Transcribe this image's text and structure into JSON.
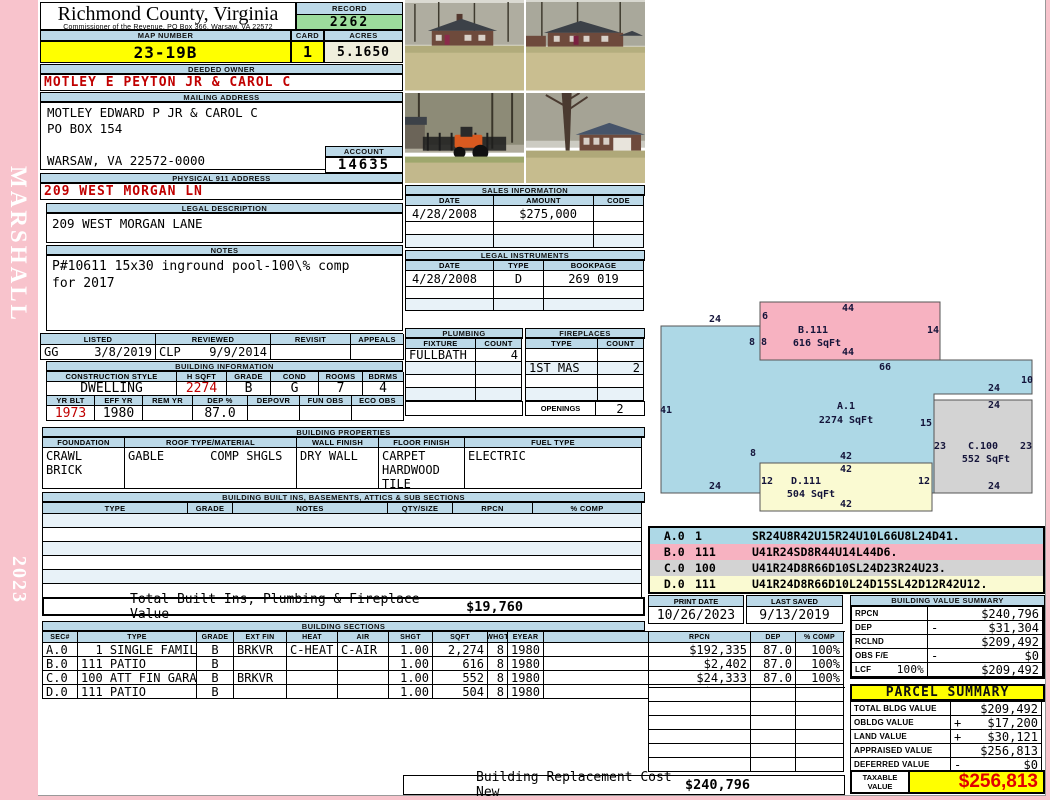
{
  "sidebar": {
    "vendor": "MARSHALL",
    "year": "2023"
  },
  "header": {
    "title": "Richmond County, Virginia",
    "subtitle": "Commissioner of the Revenue, PO Box 366, Warsaw, VA 22572",
    "record_label": "RECORD",
    "record": "2262",
    "map_label": "MAP NUMBER",
    "map": "23-19B",
    "card_label": "CARD",
    "card": "1",
    "acres_label": "ACRES",
    "acres": "5.1650"
  },
  "owner": {
    "section": "DEEDED OWNER",
    "name": "MOTLEY E PEYTON JR & CAROL C"
  },
  "mailing": {
    "section": "MAILING ADDRESS",
    "address": "MOTLEY EDWARD P JR & CAROL C\nPO BOX 154\n\nWARSAW, VA 22572-0000",
    "account_label": "ACCOUNT",
    "account": "14635"
  },
  "physical": {
    "section": "PHYSICAL 911 ADDRESS",
    "address": "209 WEST MORGAN LN"
  },
  "legal": {
    "section": "LEGAL DESCRIPTION",
    "text": "209 WEST MORGAN LANE"
  },
  "notes": {
    "section": "NOTES",
    "text": "P#10611 15x30 inground pool-100\\% comp\nfor 2017"
  },
  "review": {
    "headers": [
      "LISTED",
      "REVIEWED",
      "REVISIT",
      "APPEALS"
    ],
    "listed_by": "GG",
    "listed_date": "3/8/2019",
    "reviewed_by": "CLP",
    "reviewed_date": "9/9/2014",
    "revisit": "",
    "appeals": ""
  },
  "building_info": {
    "section": "BUILDING INFORMATION",
    "row1_headers": [
      "CONSTRUCTION STYLE",
      "H SQFT",
      "GRADE",
      "COND",
      "ROOMS",
      "BDRMS"
    ],
    "style": "DWELLING",
    "hsqft": "2274",
    "grade": "B",
    "cond": "G",
    "rooms": "7",
    "bdrms": "4",
    "row2_headers": [
      "YR BLT",
      "EFF YR",
      "REM YR",
      "DEP %",
      "DEPOVR",
      "FUN OBS",
      "ECO OBS"
    ],
    "yr_blt": "1973",
    "eff_yr": "1980",
    "rem_yr": "",
    "dep_pct": "87.0",
    "depovr": "",
    "fun_obs": "",
    "eco_obs": ""
  },
  "properties": {
    "section": "BUILDING PROPERTIES",
    "headers": [
      "FOUNDATION",
      "ROOF TYPE/MATERIAL",
      "WALL FINISH",
      "FLOOR FINISH",
      "FUEL TYPE"
    ],
    "foundation": "CRAWL\nBRICK",
    "roof_type": "GABLE",
    "roof_material": "COMP SHGLS",
    "wall_finish": "DRY WALL",
    "floor_finish": "CARPET\nHARDWOOD\nTILE",
    "fuel_type": "ELECTRIC"
  },
  "built_ins": {
    "section": "BUILDING BUILT INS, BASEMENTS, ATTICS & SUB SECTIONS",
    "headers": [
      "TYPE",
      "GRADE",
      "NOTES",
      "QTY/SIZE",
      "RPCN",
      "% COMP"
    ],
    "total_label": "Total Built Ins, Plumbing & Fireplace Value",
    "total_value": "$19,760"
  },
  "sales": {
    "section": "SALES INFORMATION",
    "headers": [
      "DATE",
      "AMOUNT",
      "CODE"
    ],
    "rows": [
      [
        "4/28/2008",
        "$275,000",
        ""
      ],
      [
        "",
        "",
        ""
      ],
      [
        "",
        "",
        ""
      ]
    ]
  },
  "instruments": {
    "section": "LEGAL INSTRUMENTS",
    "headers": [
      "DATE",
      "TYPE",
      "BOOKPAGE"
    ],
    "rows": [
      [
        "4/28/2008",
        "D",
        "269 019"
      ],
      [
        "",
        "",
        ""
      ],
      [
        "",
        "",
        ""
      ]
    ]
  },
  "plumbing": {
    "section": "PLUMBING",
    "headers": [
      "FIXTURE",
      "COUNT"
    ],
    "rows": [
      [
        "FULLBATH",
        "4"
      ],
      [
        "",
        ""
      ],
      [
        "",
        ""
      ],
      [
        "",
        ""
      ]
    ]
  },
  "fireplaces": {
    "section": "FIREPLACES",
    "headers": [
      "TYPE",
      "COUNT"
    ],
    "rows": [
      [
        "",
        ""
      ],
      [
        "1ST MAS",
        "2"
      ],
      [
        "",
        ""
      ],
      [
        "",
        ""
      ]
    ],
    "openings_label": "OPENINGS",
    "openings": "2"
  },
  "sketch": {
    "colors": {
      "blue": "#ADD8E6",
      "pink": "#F7B2C1",
      "gray": "#D3D3D3",
      "yellow": "#FAFAD2"
    },
    "shapes": [
      {
        "name": "A",
        "fill": "blue",
        "type": "polygon",
        "points": [
          [
            11,
            36
          ],
          [
            110,
            36
          ],
          [
            110,
            70
          ],
          [
            382,
            70
          ],
          [
            382,
            104
          ],
          [
            284,
            104
          ],
          [
            284,
            203
          ],
          [
            11,
            203
          ]
        ]
      },
      {
        "name": "B",
        "fill": "pink",
        "type": "rect",
        "x": 110,
        "y": 12,
        "w": 180,
        "h": 58
      },
      {
        "name": "C",
        "fill": "gray",
        "type": "rect",
        "x": 284,
        "y": 110,
        "w": 98,
        "h": 93
      },
      {
        "name": "D",
        "fill": "yellow",
        "type": "rect",
        "x": 110,
        "y": 173,
        "w": 172,
        "h": 48
      }
    ],
    "labels": [
      {
        "t": "24",
        "x": 65,
        "y": 32
      },
      {
        "t": "41",
        "x": 16,
        "y": 123
      },
      {
        "t": "24",
        "x": 65,
        "y": 199
      },
      {
        "t": "66",
        "x": 235,
        "y": 80
      },
      {
        "t": "10",
        "x": 377,
        "y": 93
      },
      {
        "t": "24",
        "x": 344,
        "y": 101
      },
      {
        "t": "15",
        "x": 276,
        "y": 136
      },
      {
        "t": "42",
        "x": 196,
        "y": 169
      },
      {
        "t": "8",
        "x": 103,
        "y": 166
      },
      {
        "t": "A.1",
        "x": 196,
        "y": 119
      },
      {
        "t": "2274 SqFt",
        "x": 196,
        "y": 133
      },
      {
        "t": "44",
        "x": 198,
        "y": 21
      },
      {
        "t": "6",
        "x": 115,
        "y": 29
      },
      {
        "t": "8",
        "x": 102,
        "y": 55
      },
      {
        "t": "8",
        "x": 114,
        "y": 55
      },
      {
        "t": "B.111",
        "x": 163,
        "y": 43
      },
      {
        "t": "616 SqFt",
        "x": 167,
        "y": 56
      },
      {
        "t": "14",
        "x": 283,
        "y": 43
      },
      {
        "t": "44",
        "x": 198,
        "y": 65
      },
      {
        "t": "24",
        "x": 344,
        "y": 118
      },
      {
        "t": "23",
        "x": 290,
        "y": 159
      },
      {
        "t": "C.100",
        "x": 333,
        "y": 159
      },
      {
        "t": "23",
        "x": 376,
        "y": 159
      },
      {
        "t": "552 SqFt",
        "x": 336,
        "y": 172
      },
      {
        "t": "24",
        "x": 344,
        "y": 199
      },
      {
        "t": "42",
        "x": 196,
        "y": 182
      },
      {
        "t": "12",
        "x": 117,
        "y": 194
      },
      {
        "t": "D.111",
        "x": 156,
        "y": 194
      },
      {
        "t": "12",
        "x": 274,
        "y": 194
      },
      {
        "t": "504 SqFt",
        "x": 161,
        "y": 207
      },
      {
        "t": "42",
        "x": 196,
        "y": 217
      }
    ]
  },
  "sketch_codes": {
    "rows": [
      {
        "sec": "A.0",
        "code": "1",
        "vector": "SR24U8R42U15R24U10L66U8L24D41.",
        "color": "blue"
      },
      {
        "sec": "B.0",
        "code": "111",
        "vector": "U41R24SD8R44U14L44D6.",
        "color": "pink"
      },
      {
        "sec": "C.0",
        "code": "100",
        "vector": "U41R24D8R66D10SL24D23R24U23.",
        "color": "gray"
      },
      {
        "sec": "D.0",
        "code": "111",
        "vector": "U41R24D8R66D10L24D15SL42D12R42U12.",
        "color": "yellow"
      }
    ]
  },
  "dates": {
    "print_label": "PRINT DATE",
    "print": "10/26/2023",
    "saved_label": "LAST SAVED",
    "saved": "9/13/2019"
  },
  "value_summary": {
    "section": "BUILDING VALUE SUMMARY",
    "rows": [
      {
        "label": "RPCN",
        "mid": "",
        "op": "",
        "value": "$240,796"
      },
      {
        "label": "DEP",
        "mid": "",
        "op": "-",
        "value": "$31,304"
      },
      {
        "label": "RCLND",
        "mid": "",
        "op": "",
        "value": "$209,492"
      },
      {
        "label": "OBS F/E",
        "mid": "",
        "op": "-",
        "value": "$0"
      },
      {
        "label": "LCF",
        "mid": "100%",
        "op": "",
        "value": "$209,492"
      }
    ]
  },
  "sections_table": {
    "section": "BUILDING SECTIONS",
    "headers": [
      "SEC#",
      "TYPE",
      "GRADE",
      "EXT FIN",
      "HEAT",
      "AIR",
      "SHGT",
      "SQFT",
      "WHGT",
      "EYEAR",
      "RPCN",
      "DEP",
      "% COMP"
    ],
    "rows": [
      {
        "sec": "A.0",
        "code": "1",
        "type": "SINGLE FAMILY",
        "grade": "B",
        "ext_fin": "BRKVR",
        "heat": "C-HEAT",
        "air": "C-AIR",
        "shgt": "1.00",
        "sqft": "2,274",
        "whgt": "8",
        "eyear": "1980",
        "rpcn": "$192,335",
        "dep": "87.0",
        "comp": "100%"
      },
      {
        "sec": "B.0",
        "code": "111",
        "type": "PATIO",
        "grade": "B",
        "ext_fin": "",
        "heat": "",
        "air": "",
        "shgt": "1.00",
        "sqft": "616",
        "whgt": "8",
        "eyear": "1980",
        "rpcn": "$2,402",
        "dep": "87.0",
        "comp": "100%"
      },
      {
        "sec": "C.0",
        "code": "100",
        "type": "ATT FIN GARAGE",
        "grade": "B",
        "ext_fin": "BRKVR",
        "heat": "",
        "air": "",
        "shgt": "1.00",
        "sqft": "552",
        "whgt": "8",
        "eyear": "1980",
        "rpcn": "$24,333",
        "dep": "87.0",
        "comp": "100%"
      },
      {
        "sec": "D.0",
        "code": "111",
        "type": "PATIO",
        "grade": "B",
        "ext_fin": "",
        "heat": "",
        "air": "",
        "shgt": "1.00",
        "sqft": "504",
        "whgt": "8",
        "eyear": "1980",
        "rpcn": "$1,966",
        "dep": "87.0",
        "comp": "100%"
      }
    ]
  },
  "parcel": {
    "title": "PARCEL SUMMARY",
    "rows": [
      {
        "label": "TOTAL BLDG VALUE",
        "op": "",
        "value": "$209,492"
      },
      {
        "label": "OBLDG VALUE",
        "op": "+",
        "value": "$17,200"
      },
      {
        "label": "LAND VALUE",
        "op": "+",
        "value": "$30,121"
      },
      {
        "label": "APPRAISED VALUE",
        "op": "",
        "value": "$256,813"
      },
      {
        "label": "DEFERRED VALUE",
        "op": "-",
        "value": "$0"
      }
    ],
    "taxable_label": "TAXABLE VALUE",
    "taxable": "$256,813"
  },
  "footer": {
    "label": "Building Replacement Cost New",
    "value": "$240,796"
  }
}
